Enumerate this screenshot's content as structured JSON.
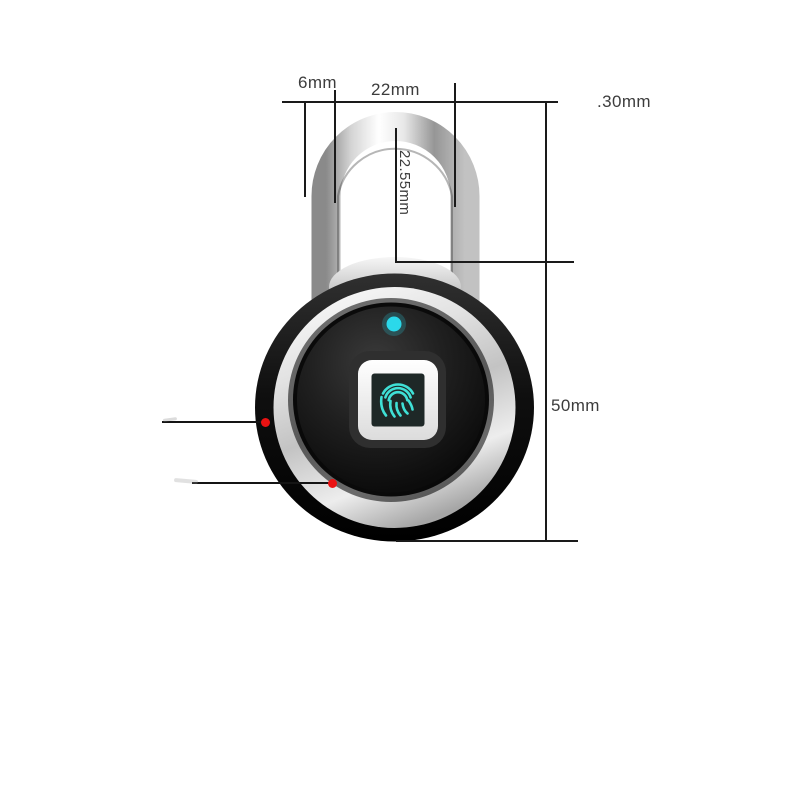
{
  "annotations": {
    "shackle_thickness": "6mm",
    "shackle_inner_width": "22mm",
    "shackle_diameter": ".30mm",
    "shackle_inner_height": "22.55mm",
    "body_height": "50mm"
  },
  "icons": {
    "fingerprint_icon": "fingerprint ridges glyph on sensor screen",
    "led_indicator": "round status LED above sensor",
    "marker_dot": "red callout dot with leader line"
  },
  "colors": {
    "background": "#ffffff",
    "dimension_line": "#1a1a1a",
    "label_text": "#3c3c3c",
    "marker_red": "#ea1212",
    "led_cyan": "#2bd8ea",
    "fingerprint_cyan": "#3fe0d6",
    "body_face_black": "#0d0d0d",
    "chrome_silver": "#d6d6d6"
  }
}
